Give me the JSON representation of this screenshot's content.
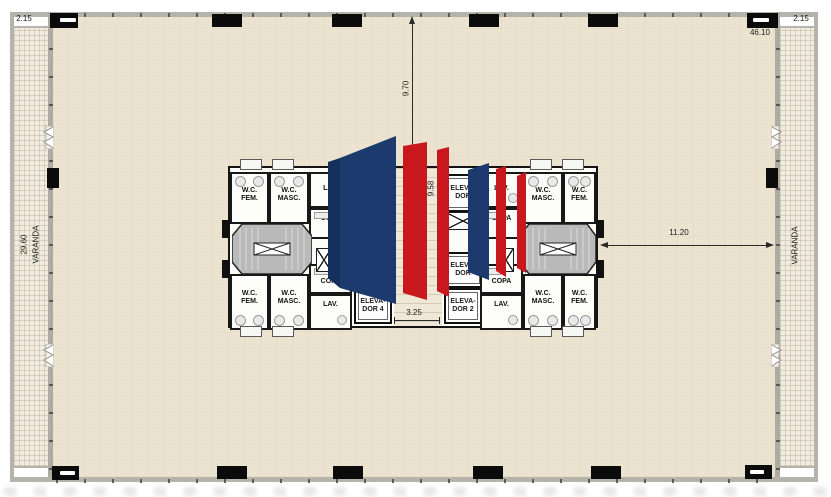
{
  "plan": {
    "dimensions": {
      "varanda_width_left": "2.15",
      "varanda_width_right": "2.15",
      "overall_width": "46.10",
      "overall_depth": "29.60",
      "core_to_top_wall": "9.70",
      "core_depth": "9.58",
      "corridor_width": "3.25",
      "core_to_right_varanda": "11.20"
    },
    "labels": {
      "varanda_left": "VARANDA",
      "varanda_right": "VARANDA",
      "wc": "W.C.",
      "fem": "FEM.",
      "masc": "MASC.",
      "lav": "LAV.",
      "copa": "COPA"
    },
    "elevators": {
      "prefix": "ELEVA-",
      "elev4": "DOR 4",
      "elev2": "DOR 2",
      "unnumbered": "DOR"
    },
    "logo_colors": {
      "navy": "#1c3a6d",
      "navy_dark": "#15305c",
      "red": "#c8181e"
    }
  }
}
